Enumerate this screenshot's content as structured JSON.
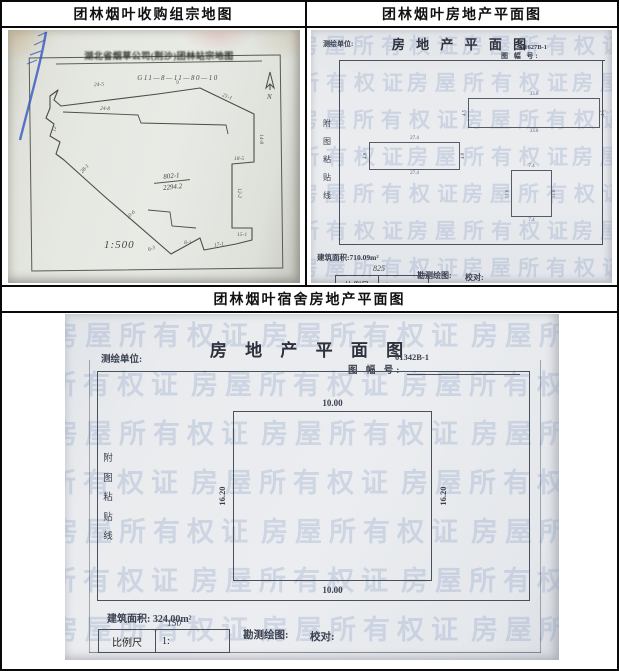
{
  "titles": {
    "top_left": "团林烟叶收购组宗地图",
    "top_right": "团林烟叶房地产平面图",
    "bottom": "团林烟叶宿舍房地产平面图"
  },
  "parcel_map": {
    "doc_title": "湖北省烟草公司(荆沙)团林站宗地图",
    "parcel_code": "G11—8—11—80—10",
    "north_label": "N",
    "parcel_number": "802-1",
    "parcel_area": "2294.2",
    "scale": "1:500",
    "pen_color": "#3558c0",
    "edge_labels": [
      {
        "t": "24-5",
        "x": 86,
        "y": 52,
        "r": -3
      },
      {
        "t": "9",
        "x": 168,
        "y": 50,
        "r": 0
      },
      {
        "t": "21-1",
        "x": 214,
        "y": 64,
        "r": 22
      },
      {
        "t": "14-8",
        "x": 248,
        "y": 106,
        "r": 90
      },
      {
        "t": "18-5",
        "x": 226,
        "y": 126,
        "r": 0
      },
      {
        "t": "12-2",
        "x": 226,
        "y": 160,
        "r": 90
      },
      {
        "t": "15-1",
        "x": 229,
        "y": 202,
        "r": 0
      },
      {
        "t": "17-1",
        "x": 206,
        "y": 212,
        "r": -8
      },
      {
        "t": "8-1",
        "x": 176,
        "y": 210,
        "r": 0
      },
      {
        "t": "10-6",
        "x": 118,
        "y": 182,
        "r": -42
      },
      {
        "t": "28-1",
        "x": 72,
        "y": 136,
        "r": -48
      },
      {
        "t": "24-8",
        "x": 92,
        "y": 76,
        "r": 2
      },
      {
        "t": "12",
        "x": 44,
        "y": 96,
        "r": -80
      },
      {
        "t": "6-3",
        "x": 140,
        "y": 216,
        "r": -20
      }
    ]
  },
  "estate_plan": {
    "surveyor_label": "测绘单位:",
    "form_title": "房 地 产 平 面 图",
    "sheet_code": "01627B-1",
    "sheet_no_label": "图 幅 号:",
    "paste_chars": [
      "附",
      "图",
      "粘",
      "贴",
      "线"
    ],
    "watermark": "房屋所有权证",
    "area_text": "建筑面积:710.09m²",
    "scale_label": "比例尺",
    "scale_prefix": "1:",
    "scale_value": "825",
    "survey_label": "勘测绘图:",
    "check_label": "校对:",
    "buildings": [
      {
        "x": 157,
        "y": 68,
        "w": 130,
        "h": 28,
        "top": "33.0",
        "bottom": "33.0",
        "left": "4.5",
        "right": "4.5"
      },
      {
        "x": 58,
        "y": 112,
        "w": 89,
        "h": 26,
        "top": "27.4",
        "bottom": "27.4",
        "left": "4.8",
        "right": "4.8"
      },
      {
        "x": 200,
        "y": 140,
        "w": 39,
        "h": 45,
        "top": "7.4",
        "bottom": "7.4",
        "left": "11.6",
        "right": "11.6"
      }
    ]
  },
  "dorm_plan": {
    "surveyor_label": "测绘单位:",
    "form_title": "房 地 产 平 面 图",
    "sheet_code": "01342B-1",
    "sheet_no_label": "图 幅 号:",
    "paste_chars": [
      "附",
      "图",
      "粘",
      "贴",
      "线"
    ],
    "watermark": "房屋所有权证",
    "building_dims": {
      "top": "10.00",
      "bottom": "10.00",
      "left": "16.20",
      "right": "16.20"
    },
    "area_text": "建筑面积: 324.00m²",
    "scale_label": "比例尺",
    "scale_prefix": "1:",
    "scale_value": "150",
    "survey_label": "勘测绘图:",
    "check_label": "校对:"
  }
}
